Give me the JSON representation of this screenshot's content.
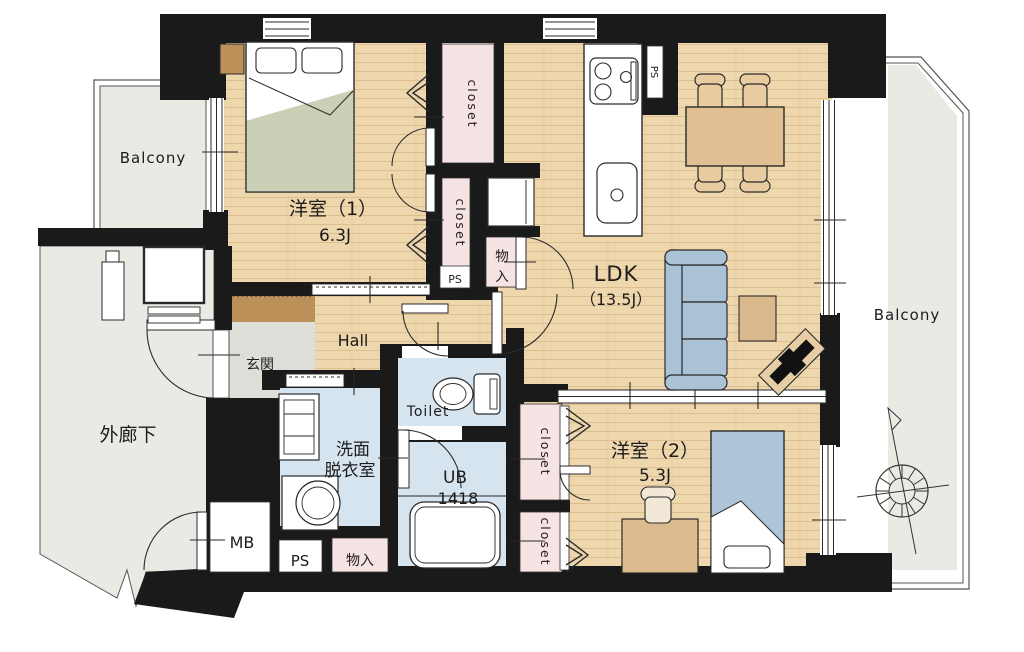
{
  "plan": {
    "rooms": {
      "bedroom1": {
        "name": "洋室（1）",
        "size": "6.3J"
      },
      "bedroom2": {
        "name": "洋室（2）",
        "size": "5.3J"
      },
      "ldk": {
        "name": "LDK",
        "size": "（13.5J）"
      },
      "hall": "Hall",
      "entrance": "玄関",
      "corridor": "外廊下",
      "balcony": "Balcony",
      "washroom_line1": "洗面",
      "washroom_line2": "脱衣室",
      "toilet": "Toilet",
      "bath_name": "UB",
      "bath_size": "1418"
    },
    "storage": {
      "closet": "closet",
      "monoire": "物入",
      "monoire_char_top": "物",
      "monoire_char_bottom": "入",
      "ps": "PS",
      "mb": "MB"
    },
    "colors": {
      "wall": "#1a1a1a",
      "wood_floor": "#eed7ad",
      "outdoor_grey": "#eaeae5",
      "closet_pink": "#f6e3e3",
      "wet_blue": "#d6e4f0",
      "entrance_grey": "#deded8",
      "step_brown": "#bc9059",
      "sofa_blue": "#a9c2d6",
      "bed_green": "#c9d0b5",
      "table_tan": "#e0c092"
    }
  }
}
